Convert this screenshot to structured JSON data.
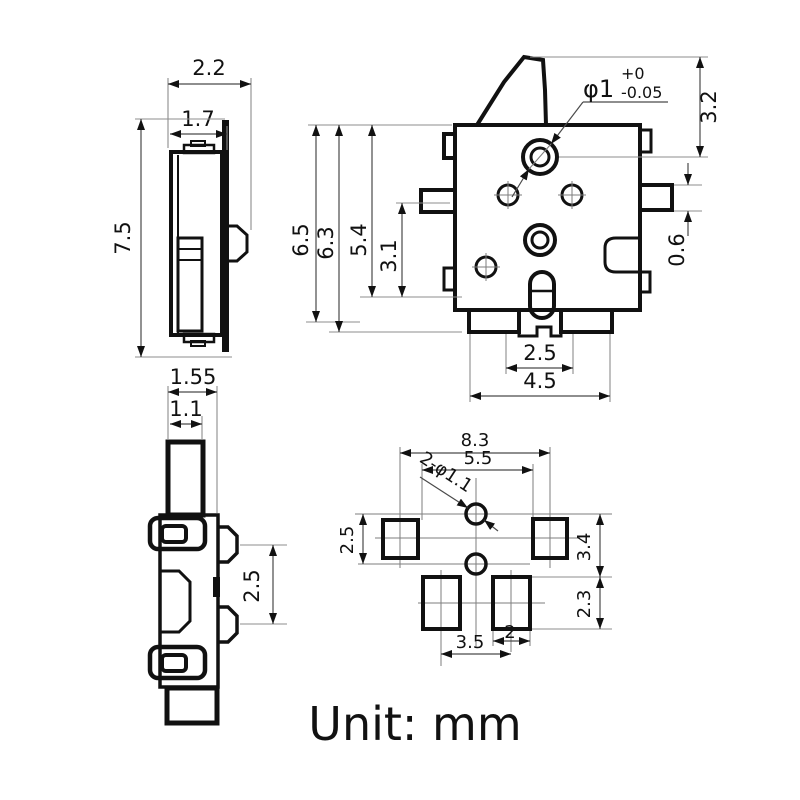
{
  "unit_label": "Unit: mm",
  "views": {
    "side_view": {
      "dims": {
        "depth_outer": "2.2",
        "depth_body": "1.7",
        "height_total": "7.5"
      }
    },
    "front_view": {
      "dims": {
        "hole_dia": "φ1",
        "hole_tol_plus": "+0",
        "hole_tol_minus": "-0.05",
        "lever_to_hole": "3.2",
        "height_a": "6.5",
        "height_b": "6.3",
        "height_c": "5.4",
        "height_d": "3.1",
        "terminal_h": "0.6",
        "feet_span_inner": "2.5",
        "feet_span_outer": "4.5"
      }
    },
    "rear_side_view": {
      "dims": {
        "plate_outer": "1.55",
        "plate_inner": "1.1",
        "bump_pitch": "2.5"
      }
    },
    "footprint_view": {
      "dims": {
        "pad_pitch_outer": "8.3",
        "pad_span_inner": "5.5",
        "hole_callout": "2-φ1.1",
        "hole_pitch": "2.5",
        "upper_height": "3.4",
        "lower_height": "2.3",
        "bottom_pad_pitch": "3.5",
        "bottom_pad_width": "2"
      }
    }
  }
}
